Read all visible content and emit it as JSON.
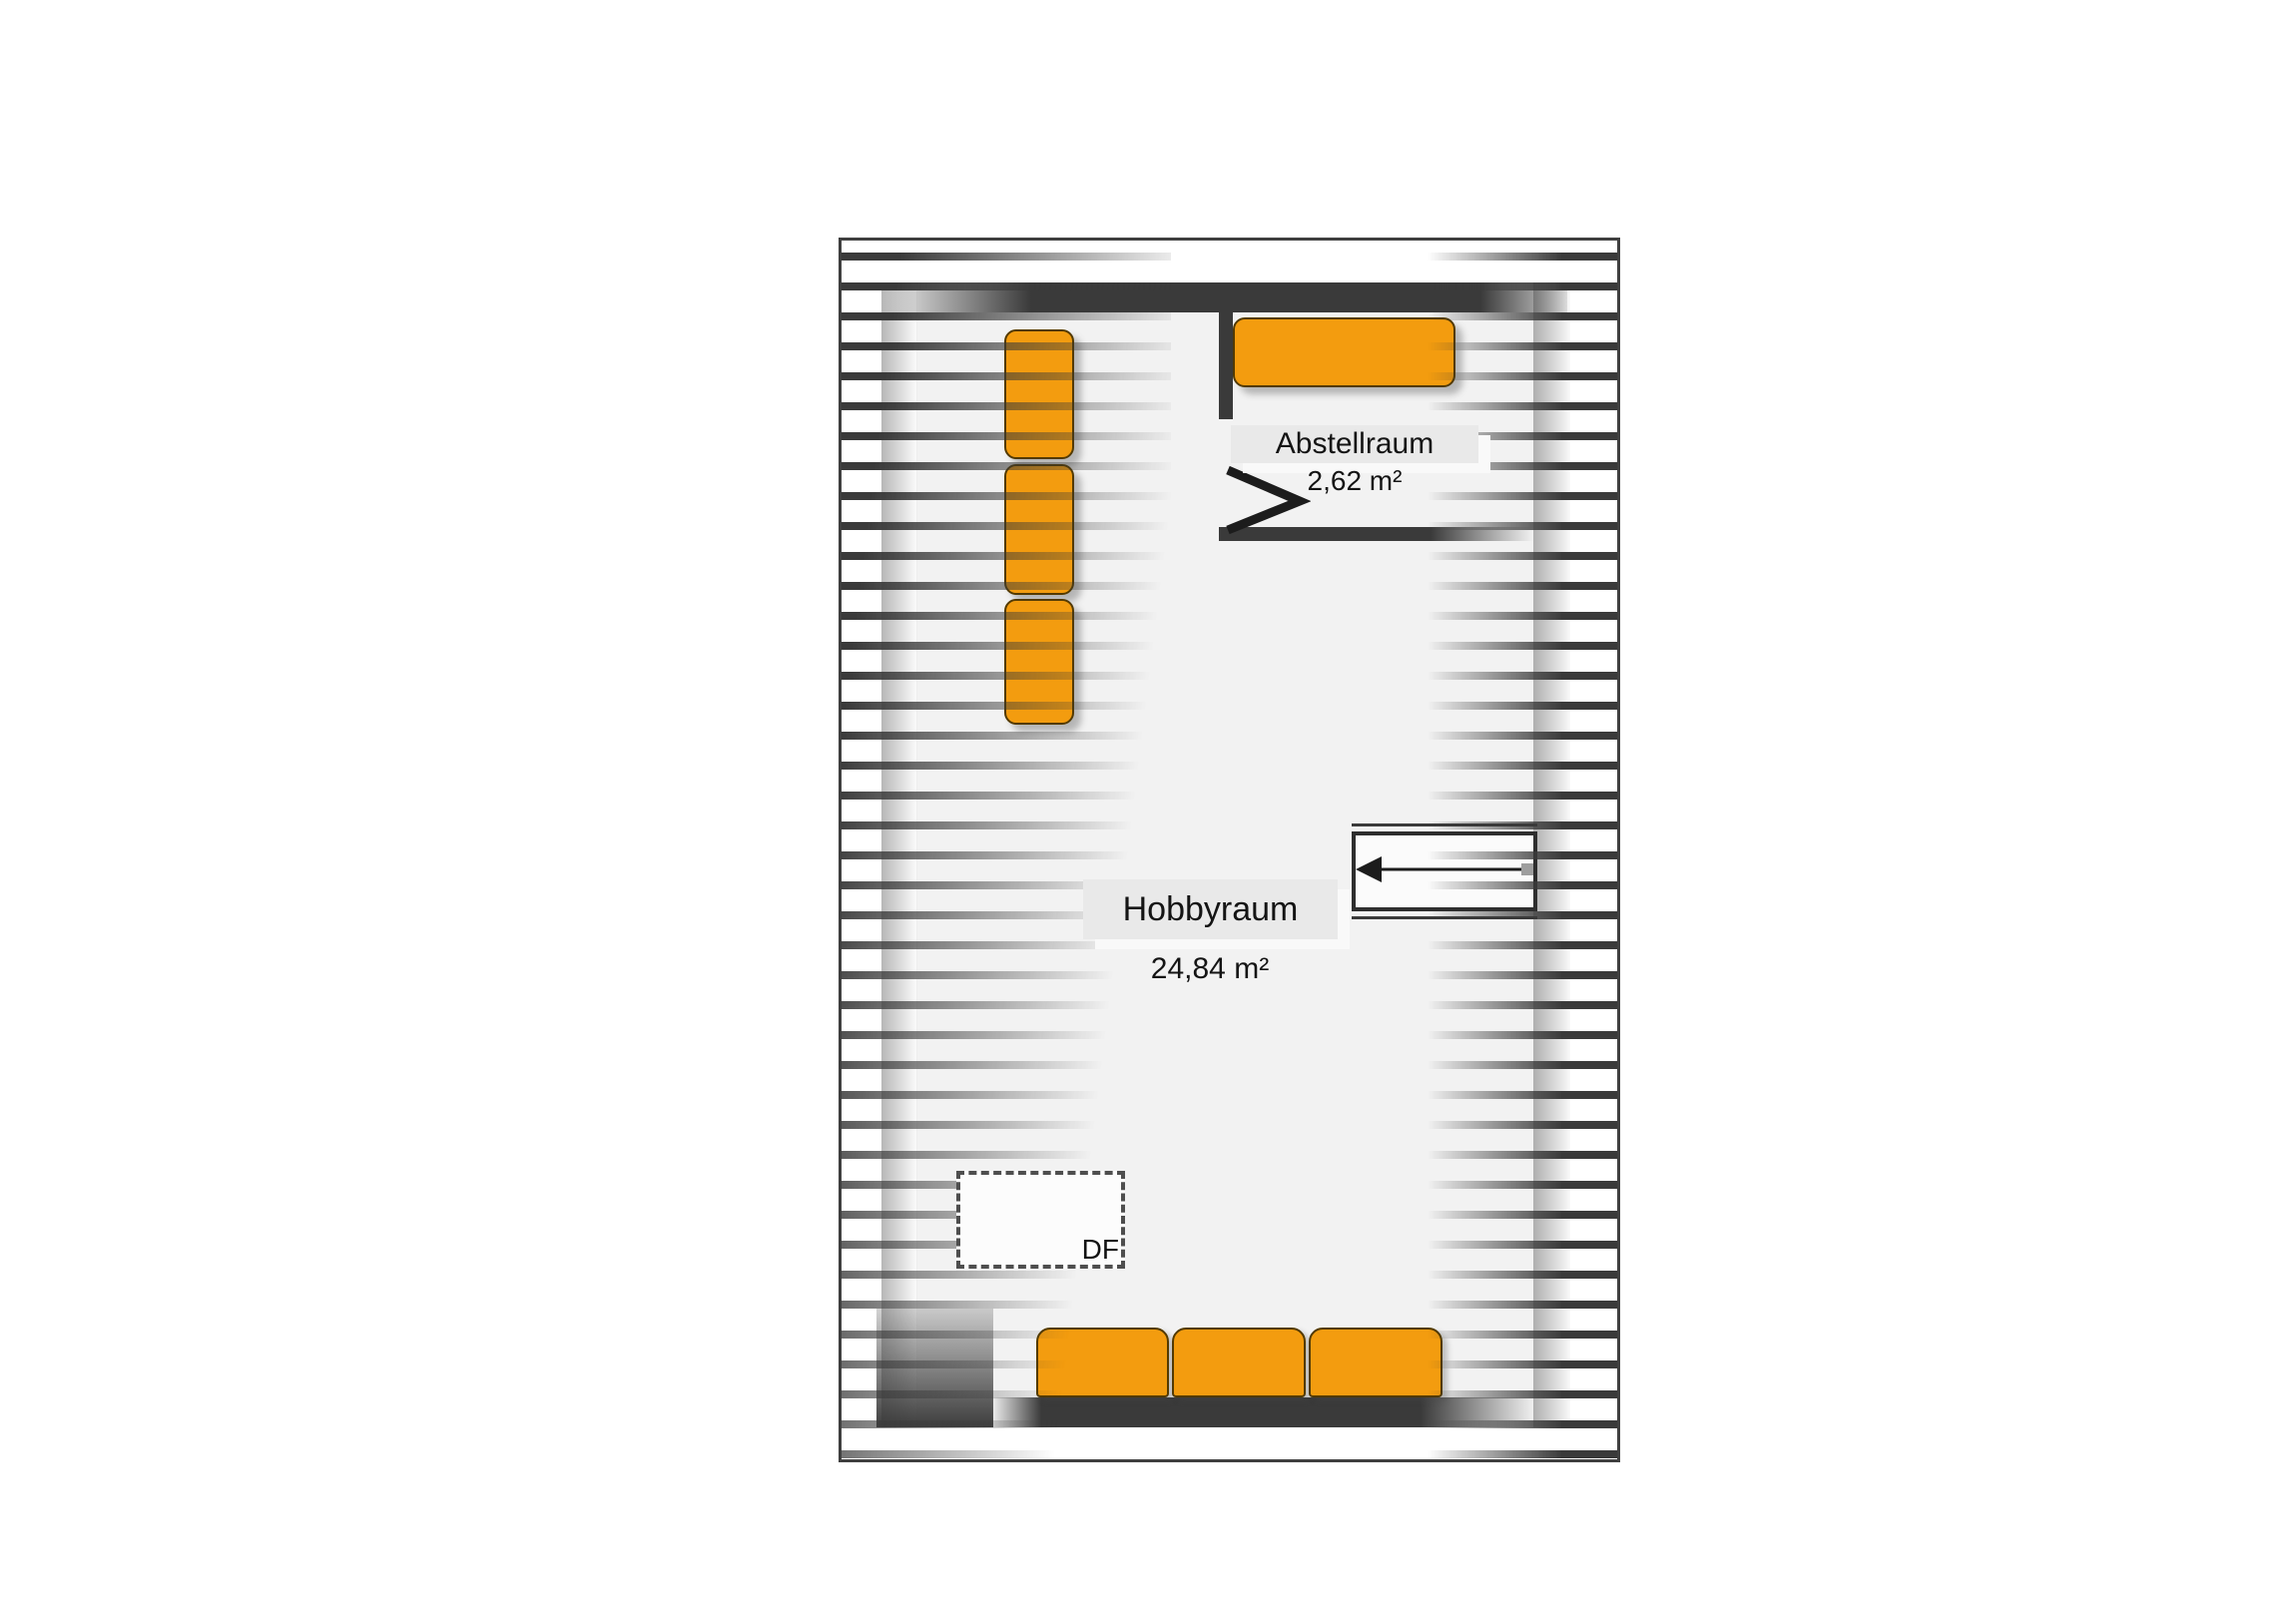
{
  "plan": {
    "title": "attic-floor-plan",
    "rooms": [
      {
        "name": "Abstellraum",
        "area": "2,62 m²"
      },
      {
        "name": "Hobbyraum",
        "area": "24,84 m²"
      }
    ],
    "roof_window": {
      "label": "DF"
    },
    "symbols": {
      "door_swing": "door-swing-icon",
      "stairs_arrow": "stairs-direction-arrow-left",
      "roof_slope_hatching": "horizontal-stripes"
    },
    "colors": {
      "wall": "#3a3a3a",
      "hatch": "#3a3a3a",
      "interior_floor": "#f2f2f2",
      "furniture": "#f39c0f",
      "furniture_border": "#533a00",
      "label_background": "#e9e9e9",
      "page_background": "#ffffff"
    }
  }
}
